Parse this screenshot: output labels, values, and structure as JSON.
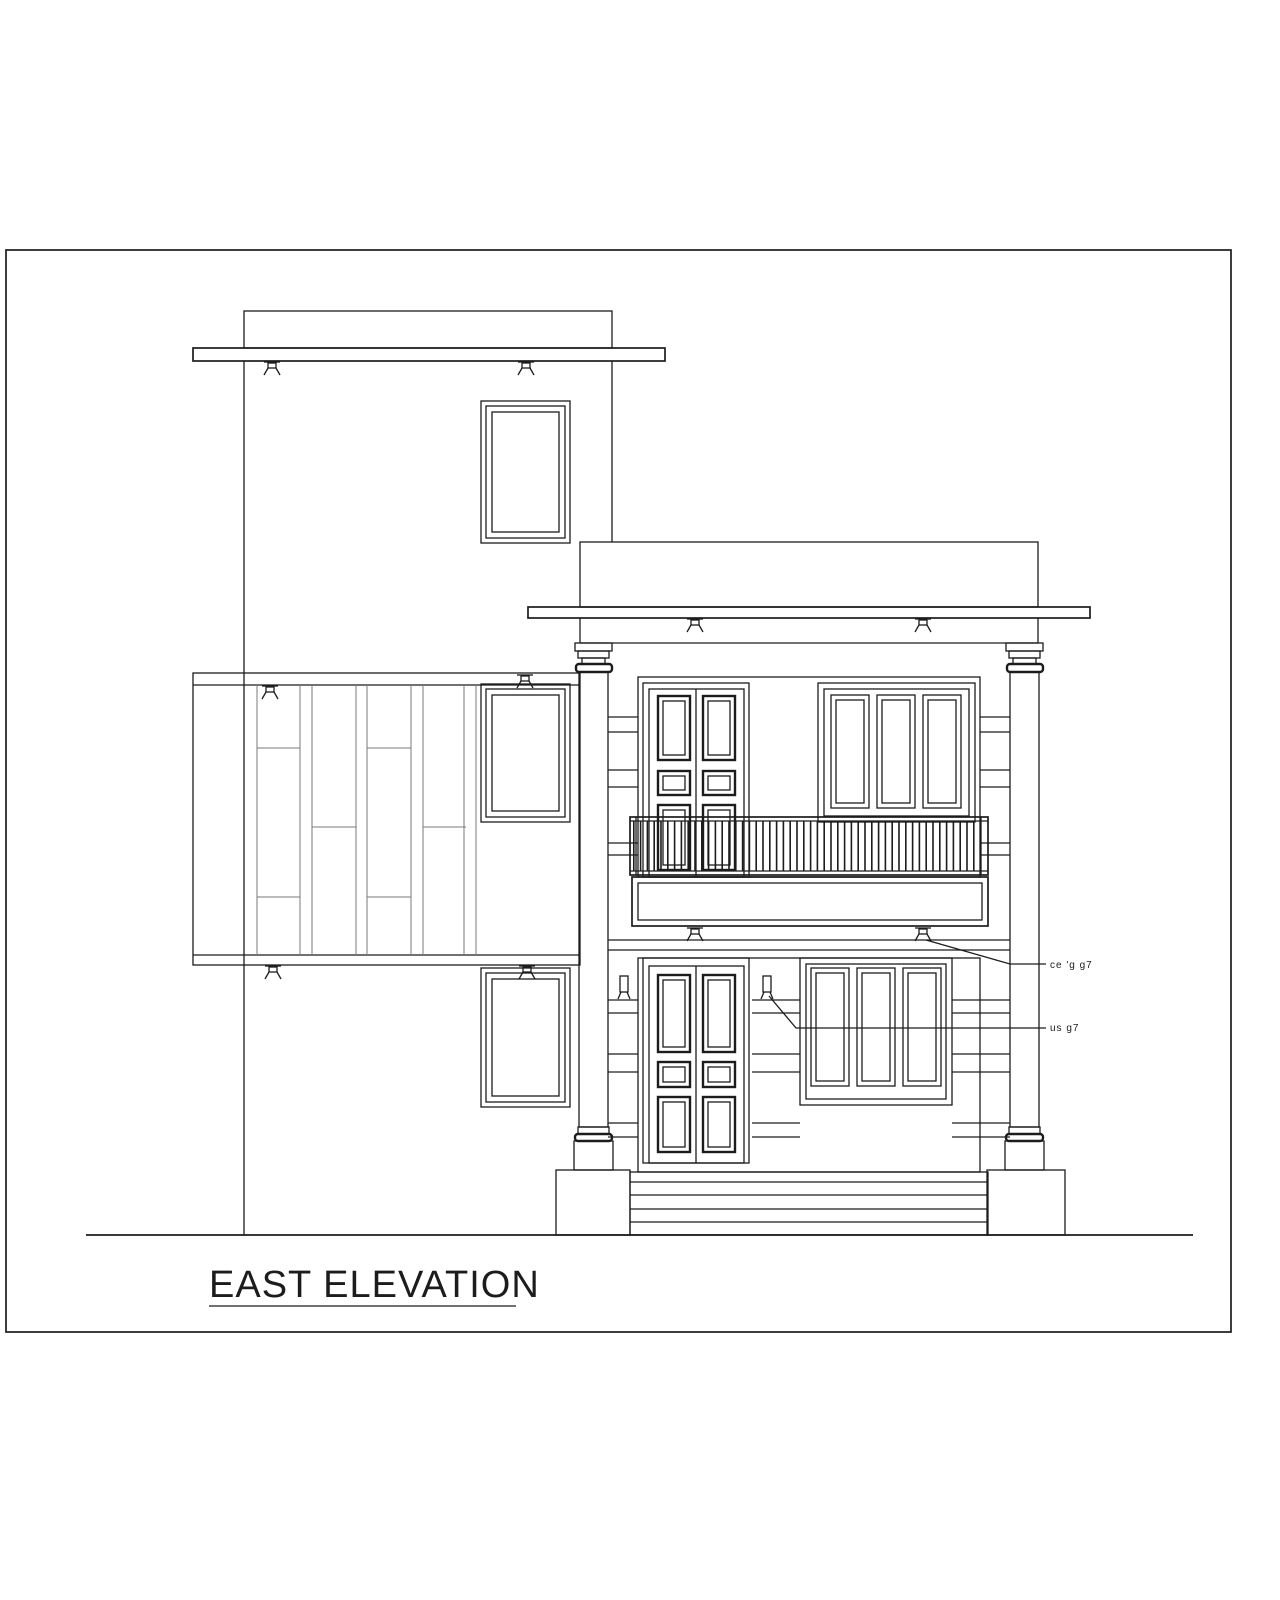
{
  "sheet": {
    "background": "#ffffff",
    "line_color": "#1c1c1c",
    "title": {
      "text": "EAST ELEVATION",
      "underlined": true
    },
    "annotations": {
      "note_upper": {
        "text": "ce 'g  g7"
      },
      "note_lower": {
        "text": "us  g7"
      }
    }
  }
}
